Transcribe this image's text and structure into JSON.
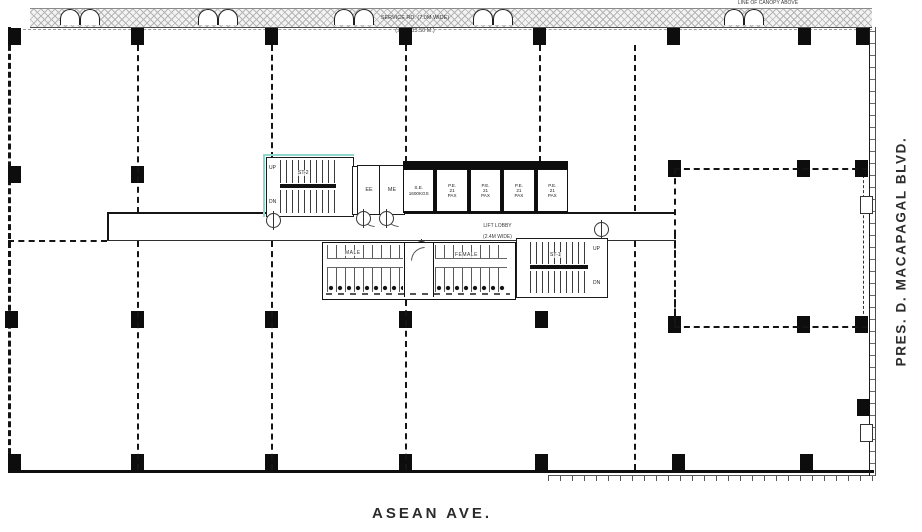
{
  "streets": {
    "east": "PRES. D. MACAPAGAL BLVD.",
    "south": "ASEAN AVE."
  },
  "service_road": {
    "line1": "SERVICE RD. (7.0M WIDE)",
    "line2": "(± EL. 13.50 M.)"
  },
  "canopy_note": "LINE OF CANOPY ABOVE",
  "lift_lobby": {
    "line1": "LIFT LOBBY",
    "line2": "(2.4M WIDE)",
    "line3": "(± EL. 13.56 M.)"
  },
  "rooms": {
    "ee": "EE",
    "me": "ME",
    "male": "MALE",
    "female": "FEMALE"
  },
  "stairs": {
    "west": {
      "label": "ST-2",
      "up": "UP",
      "dn": "DN"
    },
    "east": {
      "label": "ST-1",
      "up": "UP",
      "dn": "DN"
    }
  },
  "elevators": [
    {
      "l1": "S.E.",
      "l2": "1600KGS"
    },
    {
      "l1": "P.E.",
      "l2": "21",
      "l3": "PAX"
    },
    {
      "l1": "P.E.",
      "l2": "21",
      "l3": "PAX"
    },
    {
      "l1": "P.E.",
      "l2": "21",
      "l3": "PAX"
    },
    {
      "l1": "P.E.",
      "l2": "21",
      "l3": "PAX"
    }
  ],
  "colors": {
    "accent_teal": "#8fd8cd",
    "line": "#111111",
    "hatch_gray": "#b5b5b5"
  }
}
